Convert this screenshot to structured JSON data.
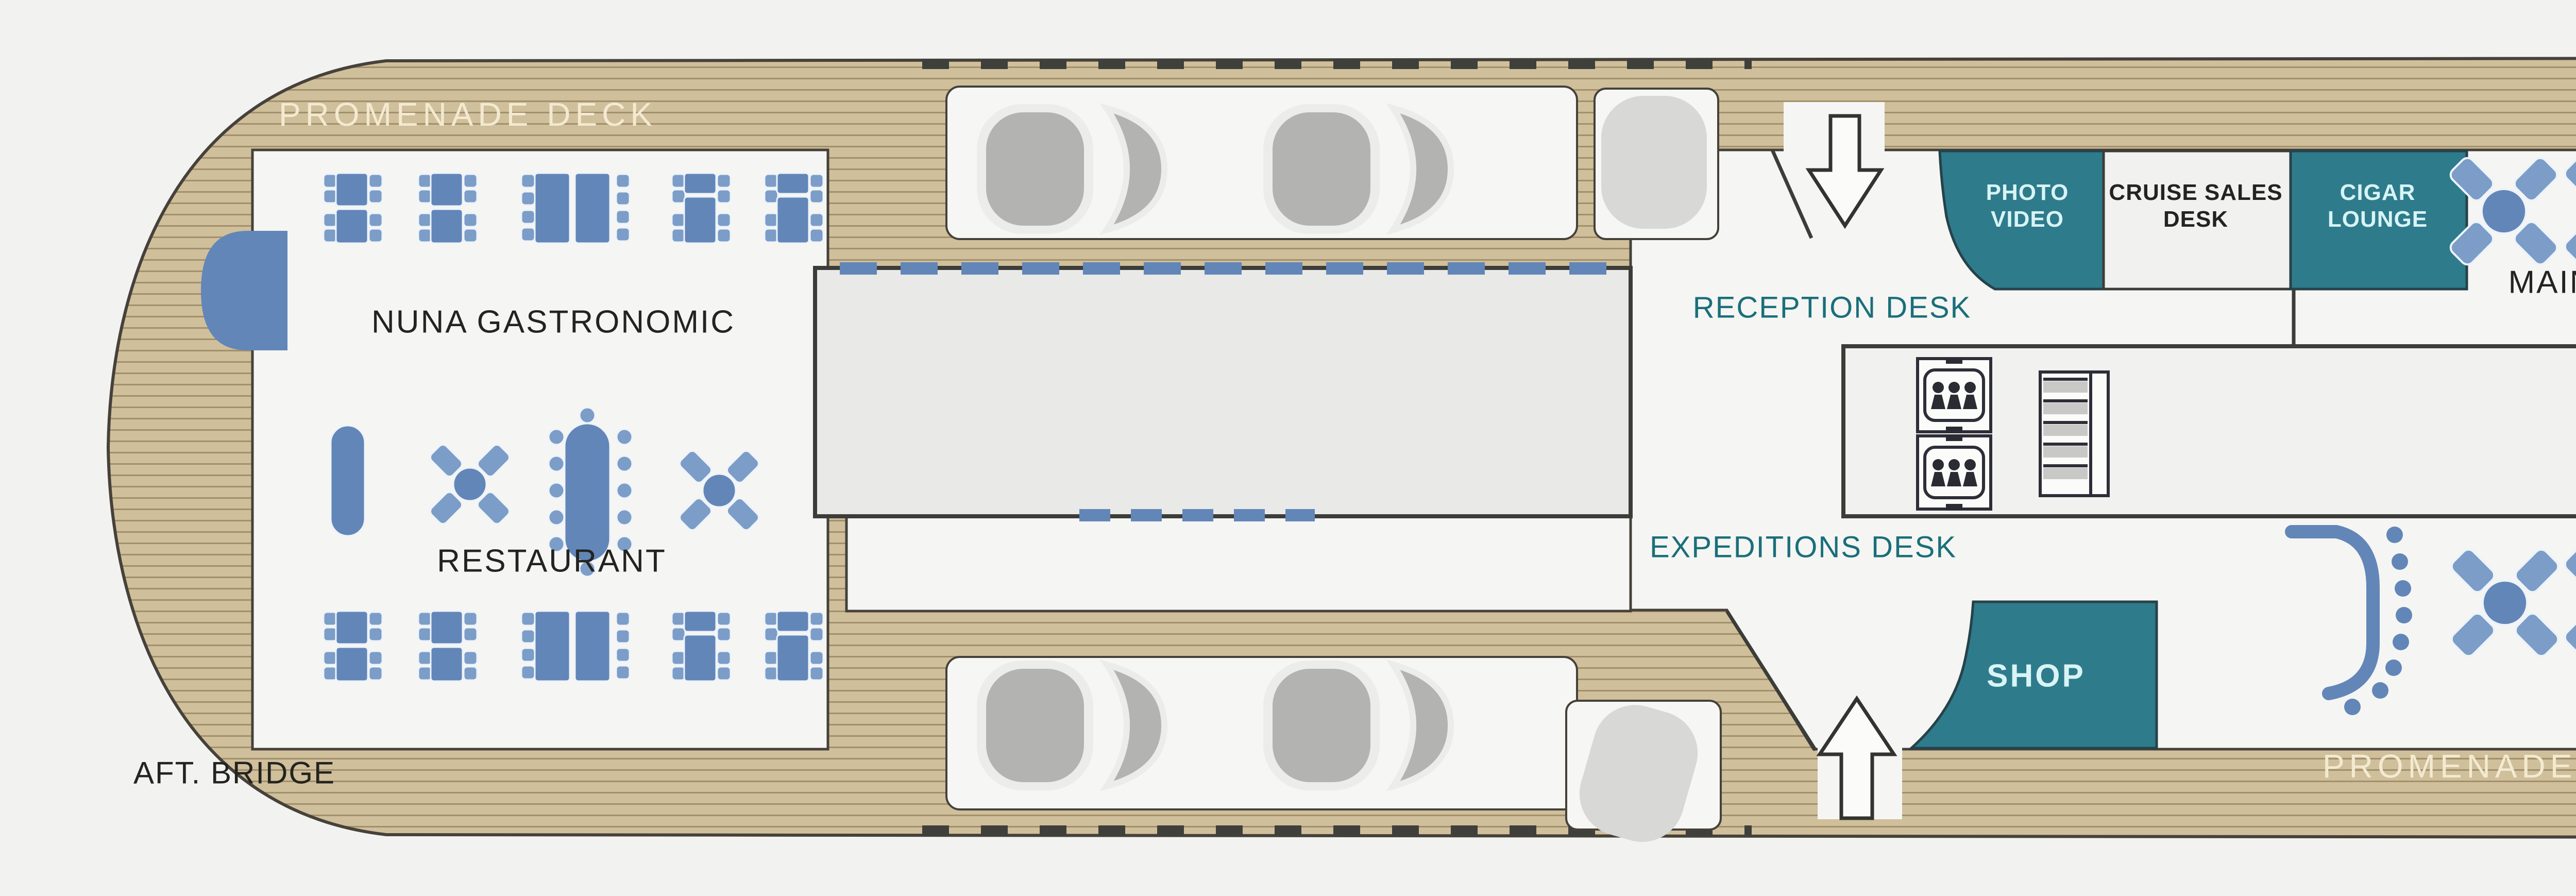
{
  "title": "Promenade Deck plan",
  "labels": {
    "promenade_deck": "PROMENADE DECK",
    "aft_bridge": "AFT. BRIDGE",
    "nuna_gastronomic": "NUNA GASTRONOMIC",
    "restaurant": "RESTAURANT",
    "reception_desk": "RECEPTION DESK",
    "expeditions_desk": "EXPEDITIONS DESK",
    "photo_video_1": "PHOTO",
    "photo_video_2": "VIDEO",
    "cruise_sales_1": "CRUISE SALES",
    "cruise_sales_2": "DESK",
    "cigar_lounge_1": "CIGAR",
    "cigar_lounge_2": "LOUNGE",
    "main_lounge": "MAIN LOUNGE",
    "shop": "SHOP",
    "theatre": "THEATRE"
  },
  "colors": {
    "teal": "#2e7b8b",
    "teal_room_text": "#d8f4f6",
    "label_teal": "#196f7a",
    "dark_text": "#23231f",
    "deck_text": "#f3ead0",
    "theatre_text": "#27496b",
    "furniture_blue": "#6286b8",
    "furniture_light": "#7b9dc8",
    "stage_blue": "#6286b8",
    "wood": "#cfbf9b",
    "wood_line": "#9a8764",
    "interior_white": "#f5f5f3",
    "block_gray": "#e9e9e7",
    "theatre_gray": "#e6e6e4",
    "zodiac_gray": "#b3b3b1",
    "background": "#f2f2f0"
  }
}
